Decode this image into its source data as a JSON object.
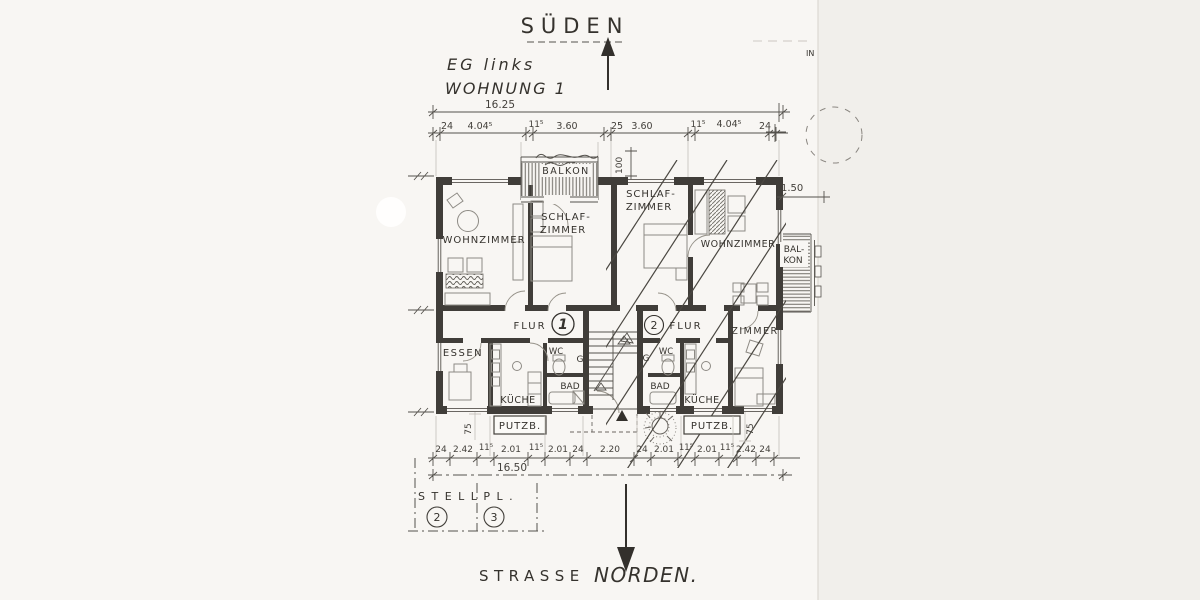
{
  "header": {
    "compass_south": "SÜDEN",
    "floor": "EG links",
    "unit": "WOHNUNG 1",
    "edge_note": "IN"
  },
  "dims": {
    "top_total": "16.25",
    "top_segments": [
      "24",
      "4.04⁵",
      "11⁵",
      "3.60",
      "25",
      "3.60",
      "11⁵",
      "4.04⁵",
      "24"
    ],
    "bottom_segments": [
      "24",
      "2.42",
      "11⁵",
      "2.01",
      "11⁵",
      "2.01",
      "24",
      "2.20",
      "24",
      "2.01",
      "11⁵",
      "2.01",
      "11⁵",
      "2.42",
      "24"
    ],
    "bottom_total": "16.50",
    "balcony_height": "100",
    "right_offset": "1.50",
    "putz_left": "75",
    "putz_right": "75"
  },
  "apartment_left": {
    "living": "WOHNZIMMER",
    "bed_line1": "SCHLAF-",
    "bed_line2": "ZIMMER",
    "balcony": "BALKON",
    "hall": "FLUR",
    "number": "1",
    "dining": "ESSEN",
    "kitchen": "KÜCHE",
    "wc": "WC",
    "bath": "BAD",
    "utility": "PUTZB.",
    "wardrobe": "G"
  },
  "apartment_right": {
    "bed_line1": "SCHLAF-",
    "bed_line2": "ZIMMER",
    "living": "WOHNZIMMER",
    "balcony_line1": "BAL-",
    "balcony_line2": "KON",
    "hall": "FLUR",
    "number": "2",
    "room": "ZIMMER",
    "kitchen": "KÜCHE",
    "wc": "WC",
    "bath": "BAD",
    "utility": "PUTZB.",
    "wardrobe": "G"
  },
  "site": {
    "parking": "STELLPL.",
    "stall_2": "2",
    "stall_3": "3",
    "street": "STRASSE",
    "north": "NORDEN."
  },
  "colors": {
    "ink": "#44413c",
    "wall": "#403d39",
    "paper": "#f8f6f3"
  },
  "icons": {
    "south_arrow": "up-arrow",
    "north_arrow": "down-arrow"
  }
}
